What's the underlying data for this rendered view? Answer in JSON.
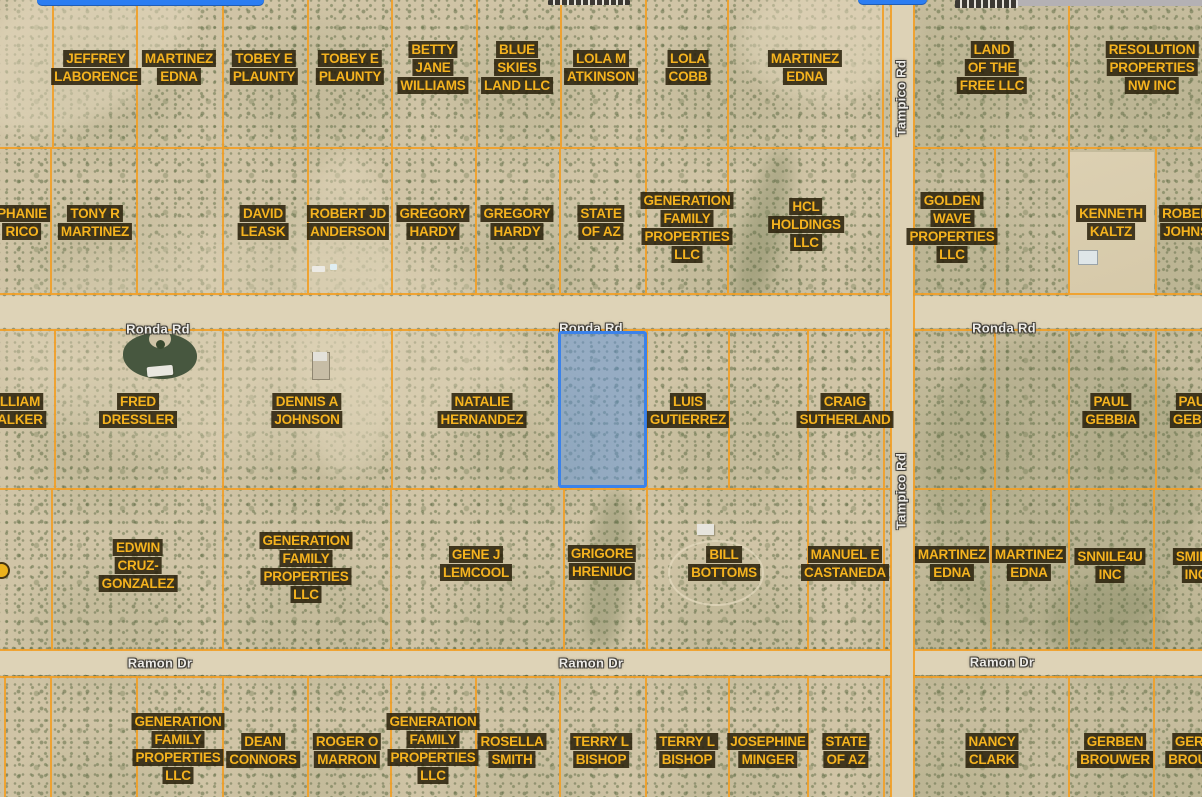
{
  "canvas": {
    "w": 1202,
    "h": 797
  },
  "colors": {
    "parcel_line": "#f1a028",
    "parcel_label_text": "#f5b31f",
    "parcel_label_bg": "rgba(40,30,8,0.86)",
    "road_label_text": "#edebe7",
    "selection_fill": "rgba(92,148,224,0.5)",
    "selection_stroke": "#3b82ea",
    "terrain": "#d0c4a6",
    "road_surface": "#ded3b7"
  },
  "roads": {
    "horizontal": [
      {
        "id": "ronda",
        "name": "Ronda Rd",
        "y": 296,
        "h": 32
      },
      {
        "id": "ramon",
        "name": "Ramon Dr",
        "y": 650,
        "h": 25
      }
    ],
    "vertical": [
      {
        "id": "tampico",
        "name": "Tampico Rd",
        "x": 891,
        "w": 22
      }
    ]
  },
  "road_labels": [
    {
      "text": "Ronda Rd",
      "x": 158,
      "y": 329,
      "vertical": false
    },
    {
      "text": "Ronda Rd",
      "x": 591,
      "y": 328,
      "vertical": false
    },
    {
      "text": "Ronda Rd",
      "x": 1004,
      "y": 328,
      "vertical": false
    },
    {
      "text": "Ramon Dr",
      "x": 160,
      "y": 663,
      "vertical": false
    },
    {
      "text": "Ramon Dr",
      "x": 591,
      "y": 663,
      "vertical": false
    },
    {
      "text": "Ramon Dr",
      "x": 1002,
      "y": 662,
      "vertical": false
    },
    {
      "text": "Tampico Rd",
      "x": 901,
      "y": 98,
      "vertical": true
    },
    {
      "text": "Tampico Rd",
      "x": 901,
      "y": 491,
      "vertical": true
    }
  ],
  "parcel_labels": [
    {
      "id": "jeffrey-laborence",
      "lines": [
        "JEFFREY",
        "LABORENCE"
      ],
      "x": 96,
      "y": 67
    },
    {
      "id": "martinez-edna-a1",
      "lines": [
        "MARTINEZ",
        "EDNA"
      ],
      "x": 179,
      "y": 67
    },
    {
      "id": "tobey-e-plaunty-1",
      "lines": [
        "TOBEY E",
        "PLAUNTY"
      ],
      "x": 264,
      "y": 67
    },
    {
      "id": "tobey-e-plaunty-2",
      "lines": [
        "TOBEY E",
        "PLAUNTY"
      ],
      "x": 350,
      "y": 67
    },
    {
      "id": "betty-jane-williams",
      "lines": [
        "BETTY",
        "JANE",
        "WILLIAMS"
      ],
      "x": 433,
      "y": 67
    },
    {
      "id": "blue-skies-land-llc",
      "lines": [
        "BLUE",
        "SKIES",
        "LAND LLC"
      ],
      "x": 517,
      "y": 67
    },
    {
      "id": "lola-m-atkinson",
      "lines": [
        "LOLA M",
        "ATKINSON"
      ],
      "x": 601,
      "y": 67
    },
    {
      "id": "lola-cobb",
      "lines": [
        "LOLA",
        "COBB"
      ],
      "x": 688,
      "y": 67
    },
    {
      "id": "martinez-edna-a2",
      "lines": [
        "MARTINEZ",
        "EDNA"
      ],
      "x": 805,
      "y": 67
    },
    {
      "id": "land-of-the-free-llc",
      "lines": [
        "LAND",
        "OF THE",
        "FREE LLC"
      ],
      "x": 992,
      "y": 67
    },
    {
      "id": "resolution-properties-nw-inc",
      "lines": [
        "RESOLUTION",
        "PROPERTIES",
        "NW INC"
      ],
      "x": 1152,
      "y": 67
    },
    {
      "id": "stephanie-rico-fragment",
      "lines": [
        "PHANIE",
        "RICO"
      ],
      "x": 22,
      "y": 222
    },
    {
      "id": "tony-r-martinez",
      "lines": [
        "TONY R",
        "MARTINEZ"
      ],
      "x": 95,
      "y": 222
    },
    {
      "id": "david-leask",
      "lines": [
        "DAVID",
        "LEASK"
      ],
      "x": 263,
      "y": 222
    },
    {
      "id": "robert-jd-anderson",
      "lines": [
        "ROBERT JD",
        "ANDERSON"
      ],
      "x": 348,
      "y": 222
    },
    {
      "id": "gregory-hardy-1",
      "lines": [
        "GREGORY",
        "HARDY"
      ],
      "x": 433,
      "y": 222
    },
    {
      "id": "gregory-hardy-2",
      "lines": [
        "GREGORY",
        "HARDY"
      ],
      "x": 517,
      "y": 222
    },
    {
      "id": "state-of-az-b",
      "lines": [
        "STATE",
        "OF AZ"
      ],
      "x": 601,
      "y": 222
    },
    {
      "id": "generation-family-properties-llc-b",
      "lines": [
        "GENERATION",
        "FAMILY",
        "PROPERTIES",
        "LLC"
      ],
      "x": 687,
      "y": 227
    },
    {
      "id": "hcl-holdings-llc",
      "lines": [
        "HCL",
        "HOLDINGS",
        "LLC"
      ],
      "x": 806,
      "y": 224
    },
    {
      "id": "golden-wave-properties-llc",
      "lines": [
        "GOLDEN",
        "WAVE",
        "PROPERTIES",
        "LLC"
      ],
      "x": 952,
      "y": 227
    },
    {
      "id": "kenneth-kaltz",
      "lines": [
        "KENNETH",
        "KALTZ"
      ],
      "x": 1111,
      "y": 222
    },
    {
      "id": "robert-johnson-fragment",
      "lines": [
        "ROBER",
        "JOHNS"
      ],
      "x": 1186,
      "y": 222
    },
    {
      "id": "william-walker-fragment",
      "lines": [
        "LLIAM",
        "ALKER"
      ],
      "x": 20,
      "y": 410
    },
    {
      "id": "fred-dressler",
      "lines": [
        "FRED",
        "DRESSLER"
      ],
      "x": 138,
      "y": 410
    },
    {
      "id": "dennis-a-johnson",
      "lines": [
        "DENNIS A",
        "JOHNSON"
      ],
      "x": 307,
      "y": 410
    },
    {
      "id": "natalie-hernandez",
      "lines": [
        "NATALIE",
        "HERNANDEZ"
      ],
      "x": 482,
      "y": 410
    },
    {
      "id": "luis-gutierrez",
      "lines": [
        "LUIS",
        "GUTIERREZ"
      ],
      "x": 688,
      "y": 410
    },
    {
      "id": "craig-sutherland",
      "lines": [
        "CRAIG",
        "SUTHERLAND"
      ],
      "x": 845,
      "y": 410
    },
    {
      "id": "paul-gebbia",
      "lines": [
        "PAUL",
        "GEBBIA"
      ],
      "x": 1111,
      "y": 410
    },
    {
      "id": "paul-gebbia-fragment",
      "lines": [
        "PAU",
        "GEBB"
      ],
      "x": 1192,
      "y": 410
    },
    {
      "id": "edwin-cruz-gonzalez",
      "lines": [
        "EDWIN",
        "CRUZ-",
        "GONZALEZ"
      ],
      "x": 138,
      "y": 565
    },
    {
      "id": "generation-family-properties-llc-d",
      "lines": [
        "GENERATION",
        "FAMILY",
        "PROPERTIES",
        "LLC"
      ],
      "x": 306,
      "y": 567
    },
    {
      "id": "gene-j-lemcool",
      "lines": [
        "GENE J",
        "LEMCOOL"
      ],
      "x": 476,
      "y": 563
    },
    {
      "id": "grigore-hreniuc",
      "lines": [
        "GRIGORE",
        "HRENIUC"
      ],
      "x": 602,
      "y": 562
    },
    {
      "id": "bill-bottoms",
      "lines": [
        "BILL",
        "BOTTOMS"
      ],
      "x": 724,
      "y": 563
    },
    {
      "id": "manuel-e-castaneda",
      "lines": [
        "MANUEL E",
        "CASTANEDA"
      ],
      "x": 845,
      "y": 563
    },
    {
      "id": "martinez-edna-d1",
      "lines": [
        "MARTINEZ",
        "EDNA"
      ],
      "x": 952,
      "y": 563
    },
    {
      "id": "martinez-edna-d2",
      "lines": [
        "MARTINEZ",
        "EDNA"
      ],
      "x": 1029,
      "y": 563
    },
    {
      "id": "snnile4u-inc",
      "lines": [
        "SNNILE4U",
        "INC"
      ],
      "x": 1110,
      "y": 565
    },
    {
      "id": "smile-inc-fragment",
      "lines": [
        "SMILE",
        "INC"
      ],
      "x": 1196,
      "y": 565
    },
    {
      "id": "generation-family-properties-llc-e1",
      "lines": [
        "GENERATION",
        "FAMILY",
        "PROPERTIES",
        "LLC"
      ],
      "x": 178,
      "y": 748
    },
    {
      "id": "dean-connors",
      "lines": [
        "DEAN",
        "CONNORS"
      ],
      "x": 263,
      "y": 750
    },
    {
      "id": "roger-o-marron",
      "lines": [
        "ROGER O",
        "MARRON"
      ],
      "x": 347,
      "y": 750
    },
    {
      "id": "generation-family-properties-llc-e2",
      "lines": [
        "GENERATION",
        "FAMILY",
        "PROPERTIES",
        "LLC"
      ],
      "x": 433,
      "y": 748
    },
    {
      "id": "rosella-smith",
      "lines": [
        "ROSELLA",
        "SMITH"
      ],
      "x": 512,
      "y": 750
    },
    {
      "id": "terry-l-bishop-1",
      "lines": [
        "TERRY L",
        "BISHOP"
      ],
      "x": 601,
      "y": 750
    },
    {
      "id": "terry-l-bishop-2",
      "lines": [
        "TERRY L",
        "BISHOP"
      ],
      "x": 687,
      "y": 750
    },
    {
      "id": "josephine-minger",
      "lines": [
        "JOSEPHINE",
        "MINGER"
      ],
      "x": 768,
      "y": 750
    },
    {
      "id": "state-of-az-e",
      "lines": [
        "STATE",
        "OF AZ"
      ],
      "x": 846,
      "y": 750
    },
    {
      "id": "nancy-clark",
      "lines": [
        "NANCY",
        "CLARK"
      ],
      "x": 992,
      "y": 750
    },
    {
      "id": "gerben-brouwer",
      "lines": [
        "GERBEN",
        "BROUWER"
      ],
      "x": 1115,
      "y": 750
    },
    {
      "id": "gerben-brouwer-fragment",
      "lines": [
        "GERB",
        "BROUW"
      ],
      "x": 1194,
      "y": 750
    }
  ],
  "selected_parcel": {
    "x": 558,
    "y": 331,
    "w": 89,
    "h": 157,
    "fill": "rgba(92,148,224,0.5)",
    "stroke": "#3b82ea"
  },
  "grid": {
    "h_lines": [
      {
        "y": 147,
        "x1": 0,
        "x2": 890
      },
      {
        "y": 147,
        "x1": 914,
        "x2": 1202
      },
      {
        "y": 293,
        "x1": 0,
        "x2": 890
      },
      {
        "y": 293,
        "x1": 914,
        "x2": 1202
      },
      {
        "y": 329,
        "x1": 0,
        "x2": 890
      },
      {
        "y": 329,
        "x1": 914,
        "x2": 1202
      },
      {
        "y": 488,
        "x1": 0,
        "x2": 890
      },
      {
        "y": 488,
        "x1": 914,
        "x2": 1202
      },
      {
        "y": 649,
        "x1": 0,
        "x2": 890
      },
      {
        "y": 649,
        "x1": 914,
        "x2": 1202
      },
      {
        "y": 676,
        "x1": 0,
        "x2": 890
      },
      {
        "y": 676,
        "x1": 914,
        "x2": 1202
      }
    ],
    "v_lines": [
      {
        "x": 890,
        "y1": 0,
        "y2": 797
      },
      {
        "x": 913,
        "y1": 0,
        "y2": 797
      },
      {
        "x": 52,
        "y1": 0,
        "y2": 147
      },
      {
        "x": 136,
        "y1": 0,
        "y2": 147
      },
      {
        "x": 222,
        "y1": 0,
        "y2": 147
      },
      {
        "x": 307,
        "y1": 0,
        "y2": 147
      },
      {
        "x": 391,
        "y1": 0,
        "y2": 147
      },
      {
        "x": 476,
        "y1": 0,
        "y2": 147
      },
      {
        "x": 560,
        "y1": 0,
        "y2": 147
      },
      {
        "x": 645,
        "y1": 0,
        "y2": 147
      },
      {
        "x": 727,
        "y1": 0,
        "y2": 147
      },
      {
        "x": 882,
        "y1": 0,
        "y2": 147
      },
      {
        "x": 1068,
        "y1": 0,
        "y2": 147
      },
      {
        "x": 50,
        "y1": 147,
        "y2": 293
      },
      {
        "x": 136,
        "y1": 147,
        "y2": 293
      },
      {
        "x": 222,
        "y1": 147,
        "y2": 293
      },
      {
        "x": 307,
        "y1": 147,
        "y2": 293
      },
      {
        "x": 391,
        "y1": 147,
        "y2": 293
      },
      {
        "x": 475,
        "y1": 147,
        "y2": 293
      },
      {
        "x": 559,
        "y1": 147,
        "y2": 293
      },
      {
        "x": 645,
        "y1": 147,
        "y2": 293
      },
      {
        "x": 727,
        "y1": 147,
        "y2": 293
      },
      {
        "x": 883,
        "y1": 147,
        "y2": 293
      },
      {
        "x": 994,
        "y1": 147,
        "y2": 293
      },
      {
        "x": 1068,
        "y1": 147,
        "y2": 293
      },
      {
        "x": 1155,
        "y1": 147,
        "y2": 293
      },
      {
        "x": 54,
        "y1": 329,
        "y2": 488
      },
      {
        "x": 222,
        "y1": 329,
        "y2": 488
      },
      {
        "x": 391,
        "y1": 329,
        "y2": 488
      },
      {
        "x": 558,
        "y1": 329,
        "y2": 488
      },
      {
        "x": 646,
        "y1": 329,
        "y2": 488
      },
      {
        "x": 728,
        "y1": 329,
        "y2": 488
      },
      {
        "x": 807,
        "y1": 329,
        "y2": 488
      },
      {
        "x": 883,
        "y1": 329,
        "y2": 488
      },
      {
        "x": 994,
        "y1": 329,
        "y2": 488
      },
      {
        "x": 1068,
        "y1": 329,
        "y2": 488
      },
      {
        "x": 1155,
        "y1": 329,
        "y2": 488
      },
      {
        "x": 51,
        "y1": 488,
        "y2": 649
      },
      {
        "x": 222,
        "y1": 488,
        "y2": 649
      },
      {
        "x": 390,
        "y1": 488,
        "y2": 649
      },
      {
        "x": 563,
        "y1": 488,
        "y2": 649
      },
      {
        "x": 646,
        "y1": 488,
        "y2": 649
      },
      {
        "x": 807,
        "y1": 488,
        "y2": 649
      },
      {
        "x": 883,
        "y1": 488,
        "y2": 649
      },
      {
        "x": 990,
        "y1": 488,
        "y2": 649
      },
      {
        "x": 1068,
        "y1": 488,
        "y2": 649
      },
      {
        "x": 1153,
        "y1": 488,
        "y2": 649
      },
      {
        "x": 4,
        "y1": 676,
        "y2": 797
      },
      {
        "x": 50,
        "y1": 676,
        "y2": 797
      },
      {
        "x": 136,
        "y1": 676,
        "y2": 797
      },
      {
        "x": 222,
        "y1": 676,
        "y2": 797
      },
      {
        "x": 307,
        "y1": 676,
        "y2": 797
      },
      {
        "x": 390,
        "y1": 676,
        "y2": 797
      },
      {
        "x": 475,
        "y1": 676,
        "y2": 797
      },
      {
        "x": 559,
        "y1": 676,
        "y2": 797
      },
      {
        "x": 645,
        "y1": 676,
        "y2": 797
      },
      {
        "x": 728,
        "y1": 676,
        "y2": 797
      },
      {
        "x": 807,
        "y1": 676,
        "y2": 797
      },
      {
        "x": 883,
        "y1": 676,
        "y2": 797
      },
      {
        "x": 1068,
        "y1": 676,
        "y2": 797
      },
      {
        "x": 1153,
        "y1": 676,
        "y2": 797
      }
    ]
  },
  "edge_artifacts": [
    {
      "id": "blue-bar-left",
      "type": "blue-bar",
      "x": 37,
      "y": 0,
      "w": 227,
      "h": 6
    },
    {
      "id": "blue-bar-mid",
      "type": "blue-bar",
      "x": 858,
      "y": 0,
      "w": 69,
      "h": 5
    },
    {
      "id": "gray-strip-top-right",
      "type": "gray-strip",
      "x": 1008,
      "y": 0,
      "w": 194,
      "h": 6
    },
    {
      "id": "clipped-road-label-1",
      "type": "dark-frag",
      "x": 548,
      "y": 0,
      "w": 82,
      "h": 5
    },
    {
      "id": "clipped-road-label-2",
      "type": "dark-frag",
      "x": 955,
      "y": 0,
      "w": 63,
      "h": 8
    },
    {
      "id": "clipped-label-dot-left",
      "type": "yellow-dot",
      "x": -7,
      "y": 562,
      "w": 13,
      "h": 13
    }
  ]
}
